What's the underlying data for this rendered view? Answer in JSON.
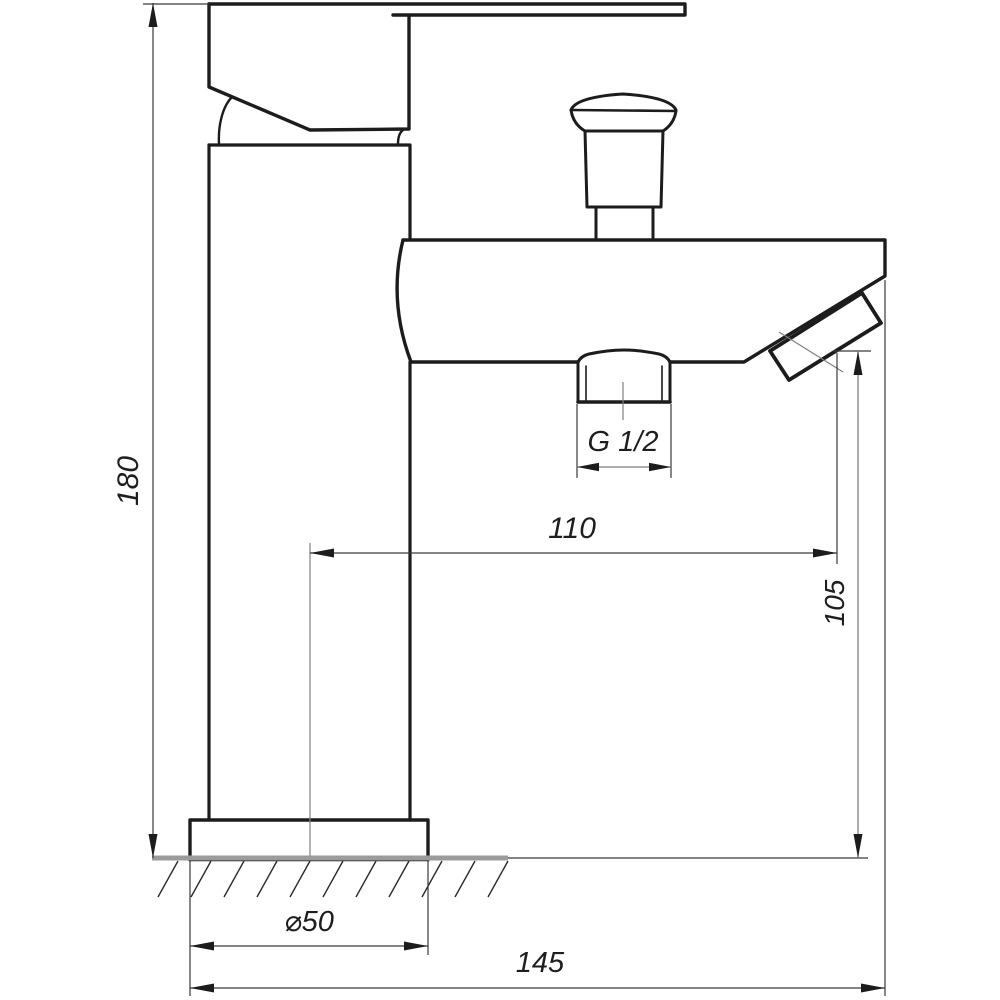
{
  "drawing": {
    "type": "technical-dimension-drawing",
    "subject": "single-lever faucet with diverter and angled spout, side view",
    "line_color": "#1c1c1c",
    "dim_line_color": "#3a3a3a",
    "aux_line_color": "#7f7f7f",
    "ground_color": "#9b9b9b",
    "dimensions": {
      "overall_height": {
        "label": "180",
        "orientation": "vertical"
      },
      "spout_reach": {
        "label": "110",
        "orientation": "horizontal"
      },
      "spout_outlet_height": {
        "label": "105",
        "orientation": "vertical"
      },
      "overall_length": {
        "label": "145",
        "orientation": "horizontal"
      },
      "base_diameter": {
        "label": "⌀50",
        "orientation": "horizontal"
      },
      "thread_size": {
        "label": "G 1/2",
        "orientation": "horizontal"
      }
    }
  }
}
